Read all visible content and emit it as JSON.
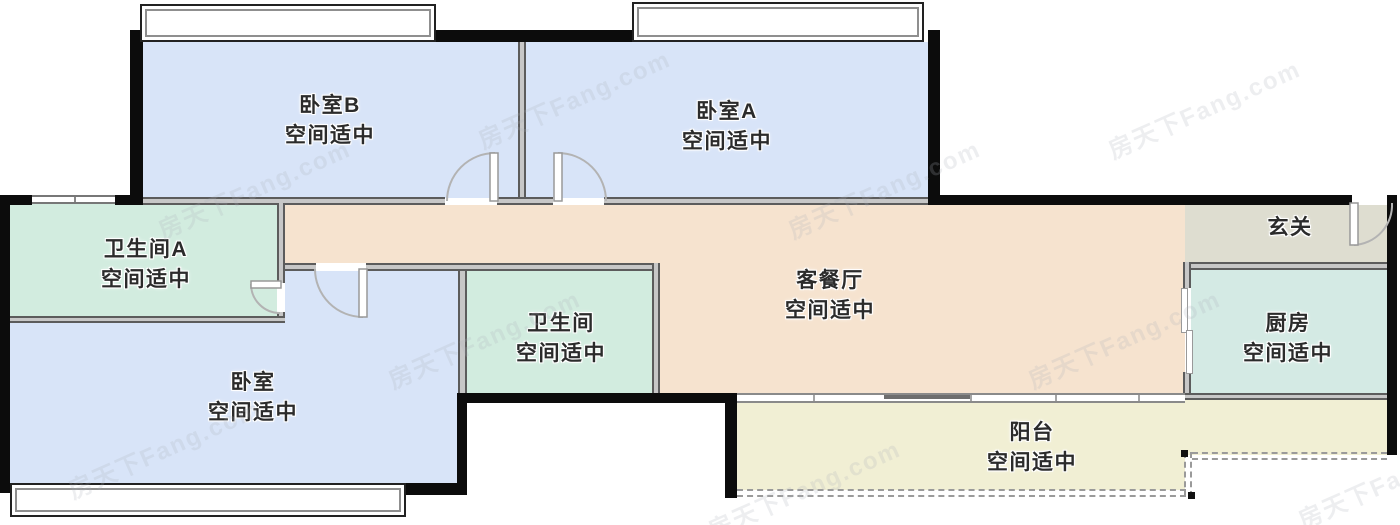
{
  "title": "户型图",
  "watermark": {
    "text": "房天下Fang.com"
  },
  "rooms": [
    {
      "id": "bedroom-b",
      "name": "卧室B",
      "note": "空间适中"
    },
    {
      "id": "bedroom-a",
      "name": "卧室A",
      "note": "空间适中"
    },
    {
      "id": "bathroom-a",
      "name": "卫生间A",
      "note": "空间适中"
    },
    {
      "id": "bedroom",
      "name": "卧室",
      "note": "空间适中"
    },
    {
      "id": "bathroom",
      "name": "卫生间",
      "note": "空间适中"
    },
    {
      "id": "living-dining",
      "name": "客餐厅",
      "note": "空间适中"
    },
    {
      "id": "entrance",
      "name": "玄关",
      "note": ""
    },
    {
      "id": "kitchen",
      "name": "厨房",
      "note": "空间适中"
    },
    {
      "id": "balcony",
      "name": "阳台",
      "note": "空间适中"
    }
  ],
  "colors": {
    "wall_black": "#0c0c0c",
    "wall_gray": "#c7c7c7",
    "wall_gray_edge": "#5c5c5c",
    "bedroom_fill": "#d8e4f8",
    "bathroom_fill": "#d2ecdf",
    "kitchen_fill": "#d4eae4",
    "living_fill": "#f6e3cf",
    "entrance_fill": "#deddd0",
    "balcony_fill": "#f1efd4",
    "label_text": "#2b2b2b"
  }
}
